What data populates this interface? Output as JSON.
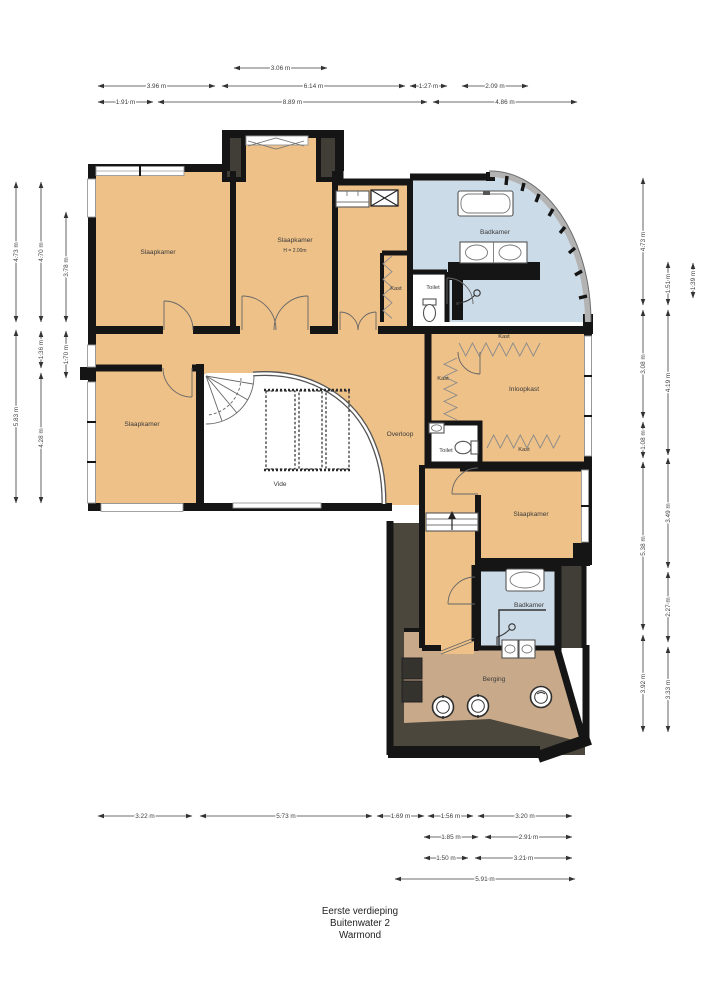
{
  "title": {
    "line1": "Eerste verdieping",
    "line2": "Buitenwater 2",
    "line3": "Warmond"
  },
  "rooms": {
    "slaapkamer_tl": "Slaapkamer",
    "slaapkamer_tm": "Slaapkamer",
    "slaapkamer_tm_height": "H = 2.00m",
    "slaapkamer_left": "Slaapkamer",
    "slaapkamer_br": "Slaapkamer",
    "badkamer_top": "Badkamer",
    "badkamer_bottom": "Badkamer",
    "kast_hal": "Kast",
    "kast_top": "Kast",
    "kast_left": "Kast",
    "kast_bottom": "Kast",
    "inloopkast": "Inloopkast",
    "toilet_top": "Toilet",
    "toilet_mid": "Toilet",
    "overloop": "Overloop",
    "vide": "Vide",
    "berging": "Berging"
  },
  "dimensions": {
    "top": [
      {
        "label": "3.06 m",
        "x1": 234,
        "x2": 327,
        "y": 68
      },
      {
        "label": "3.96 m",
        "x1": 98,
        "x2": 215,
        "y": 86
      },
      {
        "label": "6.14 m",
        "x1": 222,
        "x2": 405,
        "y": 86
      },
      {
        "label": "1.27 m",
        "x1": 410,
        "x2": 447,
        "y": 86
      },
      {
        "label": "2.09 m",
        "x1": 462,
        "x2": 528,
        "y": 86
      },
      {
        "label": "1.91 m",
        "x1": 98,
        "x2": 153,
        "y": 102
      },
      {
        "label": "8.89 m",
        "x1": 158,
        "x2": 427,
        "y": 102
      },
      {
        "label": "4.86 m",
        "x1": 433,
        "x2": 577,
        "y": 102
      }
    ],
    "left": [
      {
        "label": "4.73 m",
        "y1": 182,
        "y2": 322,
        "x": 16
      },
      {
        "label": "5.83 m",
        "y1": 330,
        "y2": 503,
        "x": 16
      },
      {
        "label": "4.70 m",
        "y1": 182,
        "y2": 322,
        "x": 41
      },
      {
        "label": "1.36 m",
        "y1": 331,
        "y2": 368,
        "x": 41
      },
      {
        "label": "4.28 m",
        "y1": 373,
        "y2": 503,
        "x": 41
      },
      {
        "label": "3.78 m",
        "y1": 212,
        "y2": 322,
        "x": 66
      },
      {
        "label": "1.70 m",
        "y1": 331,
        "y2": 378,
        "x": 66
      }
    ],
    "right": [
      {
        "label": "4.73 m",
        "y1": 178,
        "y2": 305,
        "x": 643
      },
      {
        "label": "3.08 m",
        "y1": 310,
        "y2": 418,
        "x": 643
      },
      {
        "label": "1.08 m",
        "y1": 422,
        "y2": 458,
        "x": 643
      },
      {
        "label": "5.38 m",
        "y1": 462,
        "y2": 630,
        "x": 643
      },
      {
        "label": "3.92 m",
        "y1": 635,
        "y2": 732,
        "x": 643
      },
      {
        "label": "1.51 m",
        "y1": 262,
        "y2": 305,
        "x": 668
      },
      {
        "label": "4.19 m",
        "y1": 310,
        "y2": 455,
        "x": 668
      },
      {
        "label": "3.49 m",
        "y1": 458,
        "y2": 568,
        "x": 668
      },
      {
        "label": "2.27 m",
        "y1": 572,
        "y2": 642,
        "x": 668
      },
      {
        "label": "3.33 m",
        "y1": 647,
        "y2": 732,
        "x": 668
      },
      {
        "label": "1.39 m",
        "y1": 263,
        "y2": 298,
        "x": 693
      }
    ],
    "bottom": [
      {
        "label": "3.22 m",
        "x1": 98,
        "x2": 192,
        "y": 816
      },
      {
        "label": "5.73 m",
        "x1": 200,
        "x2": 372,
        "y": 816
      },
      {
        "label": "1.69 m",
        "x1": 377,
        "x2": 424,
        "y": 816
      },
      {
        "label": "1.56 m",
        "x1": 428,
        "x2": 473,
        "y": 816
      },
      {
        "label": "3.20 m",
        "x1": 478,
        "x2": 572,
        "y": 816
      },
      {
        "label": "1.85 m",
        "x1": 424,
        "x2": 478,
        "y": 837
      },
      {
        "label": "2.91 m",
        "x1": 485,
        "x2": 572,
        "y": 837
      },
      {
        "label": "1.50 m",
        "x1": 424,
        "x2": 468,
        "y": 858
      },
      {
        "label": "3.21 m",
        "x1": 475,
        "x2": 572,
        "y": 858
      },
      {
        "label": "5.91 m",
        "x1": 395,
        "x2": 575,
        "y": 879
      }
    ]
  },
  "colors": {
    "room_orange": "#eec189",
    "bathroom_blue": "#ccdbe8",
    "berging_tan": "#c8aa8a",
    "dark_area": "#4b473d",
    "chimney_dark": "#403e37",
    "wall_black": "#151515",
    "window_gray": "#9a9a9a",
    "dimension_text": "#3c3c3c",
    "label_text": "#3a3a3a",
    "background": "#ffffff"
  }
}
